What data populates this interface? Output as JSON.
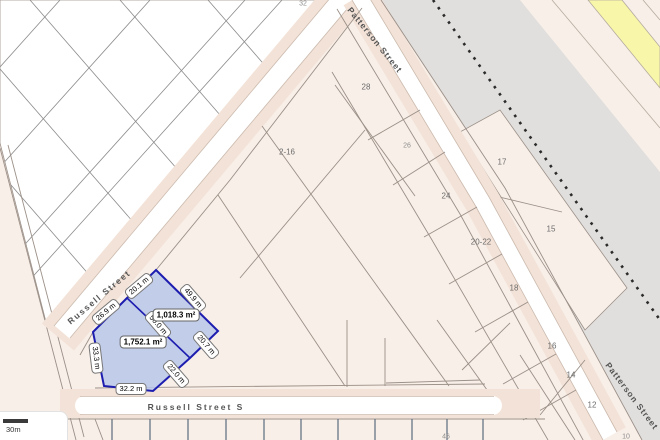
{
  "map": {
    "streets": {
      "russell": "Russell Street",
      "russell_s": "Russell Street S",
      "patterson_top": "Patterson Street",
      "patterson_bottom": "Patterson Street"
    },
    "lots": [
      {
        "n": "32"
      },
      {
        "n": "28"
      },
      {
        "n": "2-16"
      },
      {
        "n": "26"
      },
      {
        "n": "24"
      },
      {
        "n": "20-22"
      },
      {
        "n": "17"
      },
      {
        "n": "15"
      },
      {
        "n": "18"
      },
      {
        "n": "16"
      },
      {
        "n": "14"
      },
      {
        "n": "12"
      },
      {
        "n": "10"
      },
      {
        "n": "46"
      }
    ],
    "highlight": {
      "parcels": [
        {
          "area": "1,018.3 m²",
          "front": "20.1 m",
          "side_ne": "49.9 m",
          "rear": "20.7 m",
          "side_shared": "50.0 m"
        },
        {
          "area": "1,752.1 m²",
          "front": "26.9 m",
          "side_w": "33.3 m",
          "rear_s": "32.2 m",
          "side_se": "22.0 m"
        }
      ]
    },
    "scale_bar": {
      "label": "30m"
    },
    "colors": {
      "parcel_fill": "#f8efe8",
      "road_border": "#f3e2d7",
      "road_white": "#ffffff",
      "rail_gray": "#e0dfdd",
      "highway_yellow": "#f8f6a9",
      "highlight_fill": "#b8c7e9",
      "highlight_stroke": "#1d1db0",
      "boundary_line": "#9b9088"
    }
  }
}
